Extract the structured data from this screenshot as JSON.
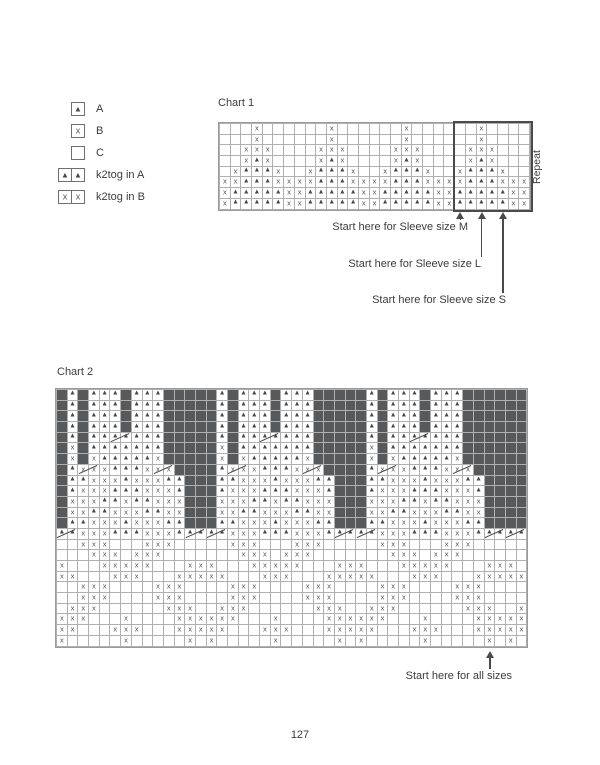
{
  "page_number": "127",
  "colors": {
    "dark_cell": "#58595b",
    "symbol": "#47474a",
    "grid_line": "#b0b0b0",
    "text": "#3c3c3e"
  },
  "legend": {
    "items": [
      {
        "icon": "triangle-in-box",
        "cells": "T",
        "label": "A"
      },
      {
        "icon": "x-in-box",
        "cells": "X",
        "label": "B"
      },
      {
        "icon": "empty-box",
        "cells": ".",
        "label": "C"
      },
      {
        "icon": "k2tog-triangle",
        "cells": "12",
        "label": "k2tog in A"
      },
      {
        "icon": "k2tog-x",
        "cells": "34",
        "label": "k2tog in B"
      }
    ]
  },
  "chart1": {
    "title": "Chart 1",
    "repeat_label": "Repeat",
    "cols": 29,
    "rows": 8,
    "motif_rows": [
      "...X...",
      "...X...",
      "..XXX..",
      "..XTX..",
      ".XTTTX.",
      "XXTTTXX",
      "XTTTTTX",
      "XTTTTTX"
    ],
    "repeats": 4,
    "extra_right_col": [
      ".",
      ".",
      ".",
      ".",
      ".",
      "X",
      "X",
      "X"
    ],
    "repeat_box": {
      "start_col": 23,
      "end_col": 29
    },
    "annotations": [
      {
        "label": "Start here for Sleeve size M",
        "arrow_col": 23
      },
      {
        "label": "Start here for Sleeve size L",
        "arrow_col": 25
      },
      {
        "label": "Start here for Sleeve size S",
        "arrow_col": 27
      }
    ]
  },
  "chart2": {
    "title": "Chart 2",
    "cols": 44,
    "rows": 24,
    "edge_col": "D",
    "block_repeats": 3,
    "block_rows": [
      "TDTTTDTTTDDDDD",
      "TDTTTDTTTDDDDD",
      "TDTTTDTTTDDDDD",
      "TDTTTDTTTDDDDD",
      "TDTT12TTTDDDDD",
      "XDTTTTTTTDDDDD",
      "XDXTTTTTXDDDDD",
      "T34XTTTX34DDDD",
      "TTXXXTXXXTTDDD",
      "TXXXTTTXXXTDDD",
      "XXXTTXTTXXXDDD",
      "XXTTXXXTTXXDDD",
      "TTXXXTXXXTTDDD"
    ],
    "bottom_masks": [
      "12XXXTTTXXXT12",
      "..XXX...XXX...",
      "...XXX.XXX....",
      "X...XXXXX...XX",
      "XX...XXX...XXX",
      "..XXX....XXX..",
      "..XXX....XXX..",
      ".XXX......XXX.",
      "XXX...X....XXX",
      "XX...XXX...XXX",
      "X.....X.....X."
    ],
    "annotation": {
      "label": "Start here for all sizes",
      "arrow_col": 41
    }
  }
}
